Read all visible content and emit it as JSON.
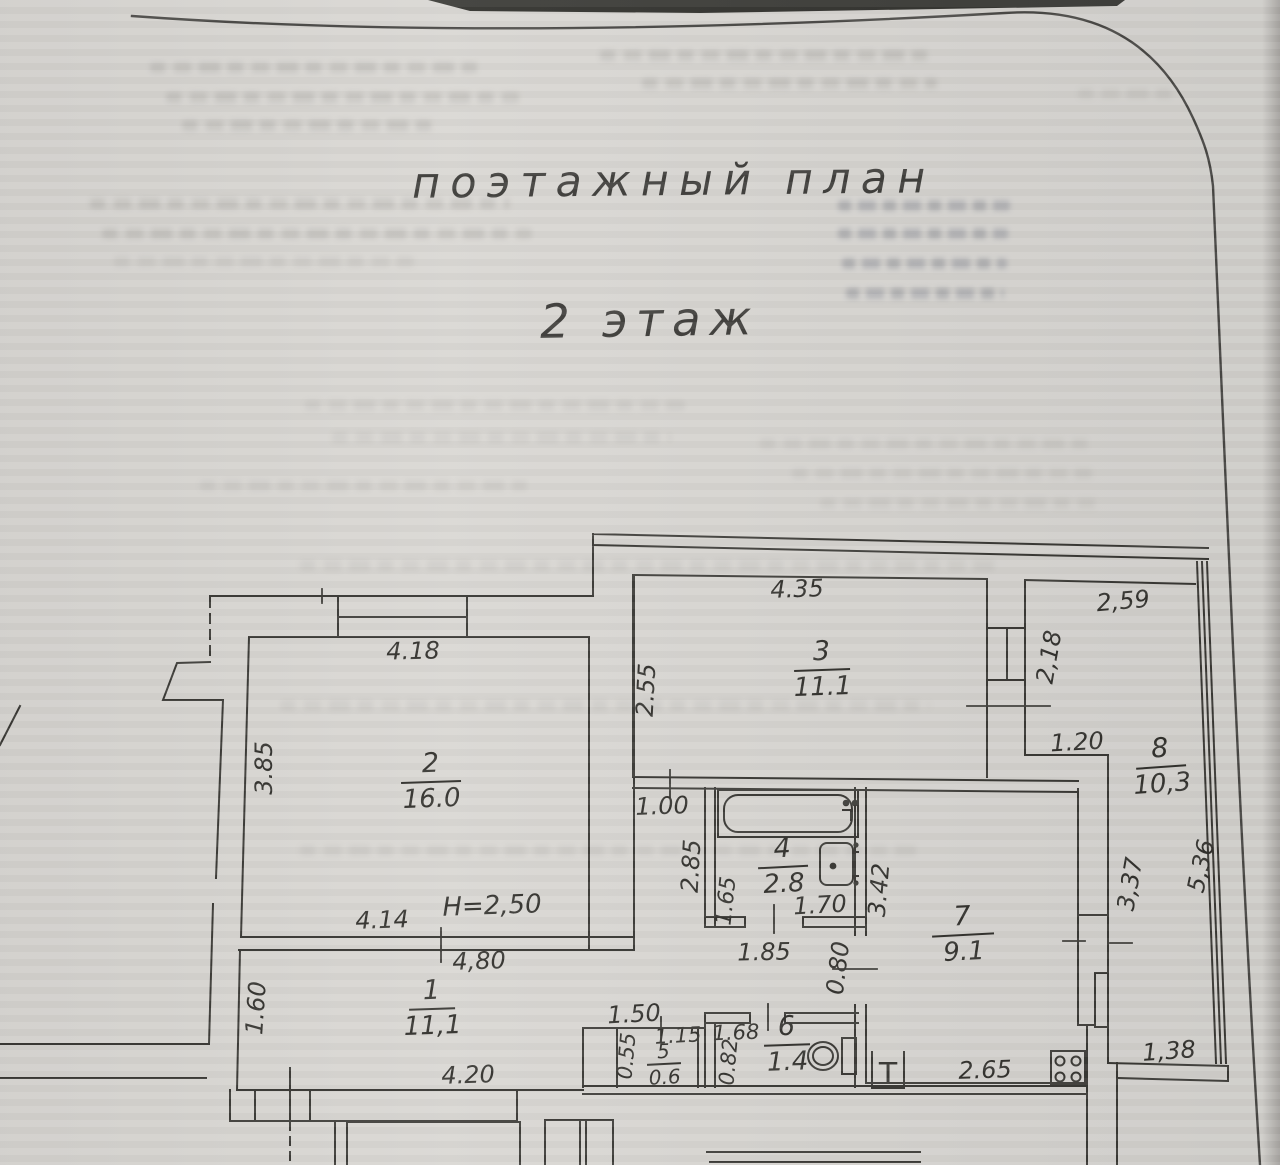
{
  "document": {
    "title": "поэтажный план",
    "subtitle": "2 этаж"
  },
  "plan": {
    "height_note": "H=2,50",
    "rooms": {
      "r1": {
        "number": "1",
        "area": "11,1"
      },
      "r2": {
        "number": "2",
        "area": "16.0"
      },
      "r3": {
        "number": "3",
        "area": "11.1"
      },
      "r4": {
        "number": "4",
        "area": "2.8"
      },
      "r5": {
        "number": "5",
        "area": "0.6"
      },
      "r6": {
        "number": "6",
        "area": "1.4"
      },
      "r7": {
        "number": "7",
        "area": "9.1"
      },
      "r8": {
        "number": "8",
        "area": "10,3"
      }
    },
    "dims": {
      "r2_top": "4.18",
      "r2_left": "3.85",
      "r2_bottom": "4.14",
      "r1_top": "4,80",
      "r1_left": "1.60",
      "r1_bottom": "4.20",
      "r3_top": "4.35",
      "r3_left": "2.55",
      "corridor": "1.00",
      "r8_top": "2,59",
      "r8_window": "2,18",
      "r8_step": "1.20",
      "r8_wall": "3,37",
      "r8_right": "5,36",
      "bath_left": "2.85",
      "bath_inner": "1.65",
      "bath_width": "1.70",
      "bath_door": "1.85",
      "kitchen_wall": "3.42",
      "kitchen_door": "0.80",
      "kitchen_bottom": "2.65",
      "loggia_bottom": "1,38",
      "nook_top": "1.50",
      "r5_top": "1.15",
      "r5_left": "0.55",
      "r6_top": "1.68",
      "r6_left": "0.82"
    },
    "symbols": {
      "vent_duct": "Т"
    }
  }
}
